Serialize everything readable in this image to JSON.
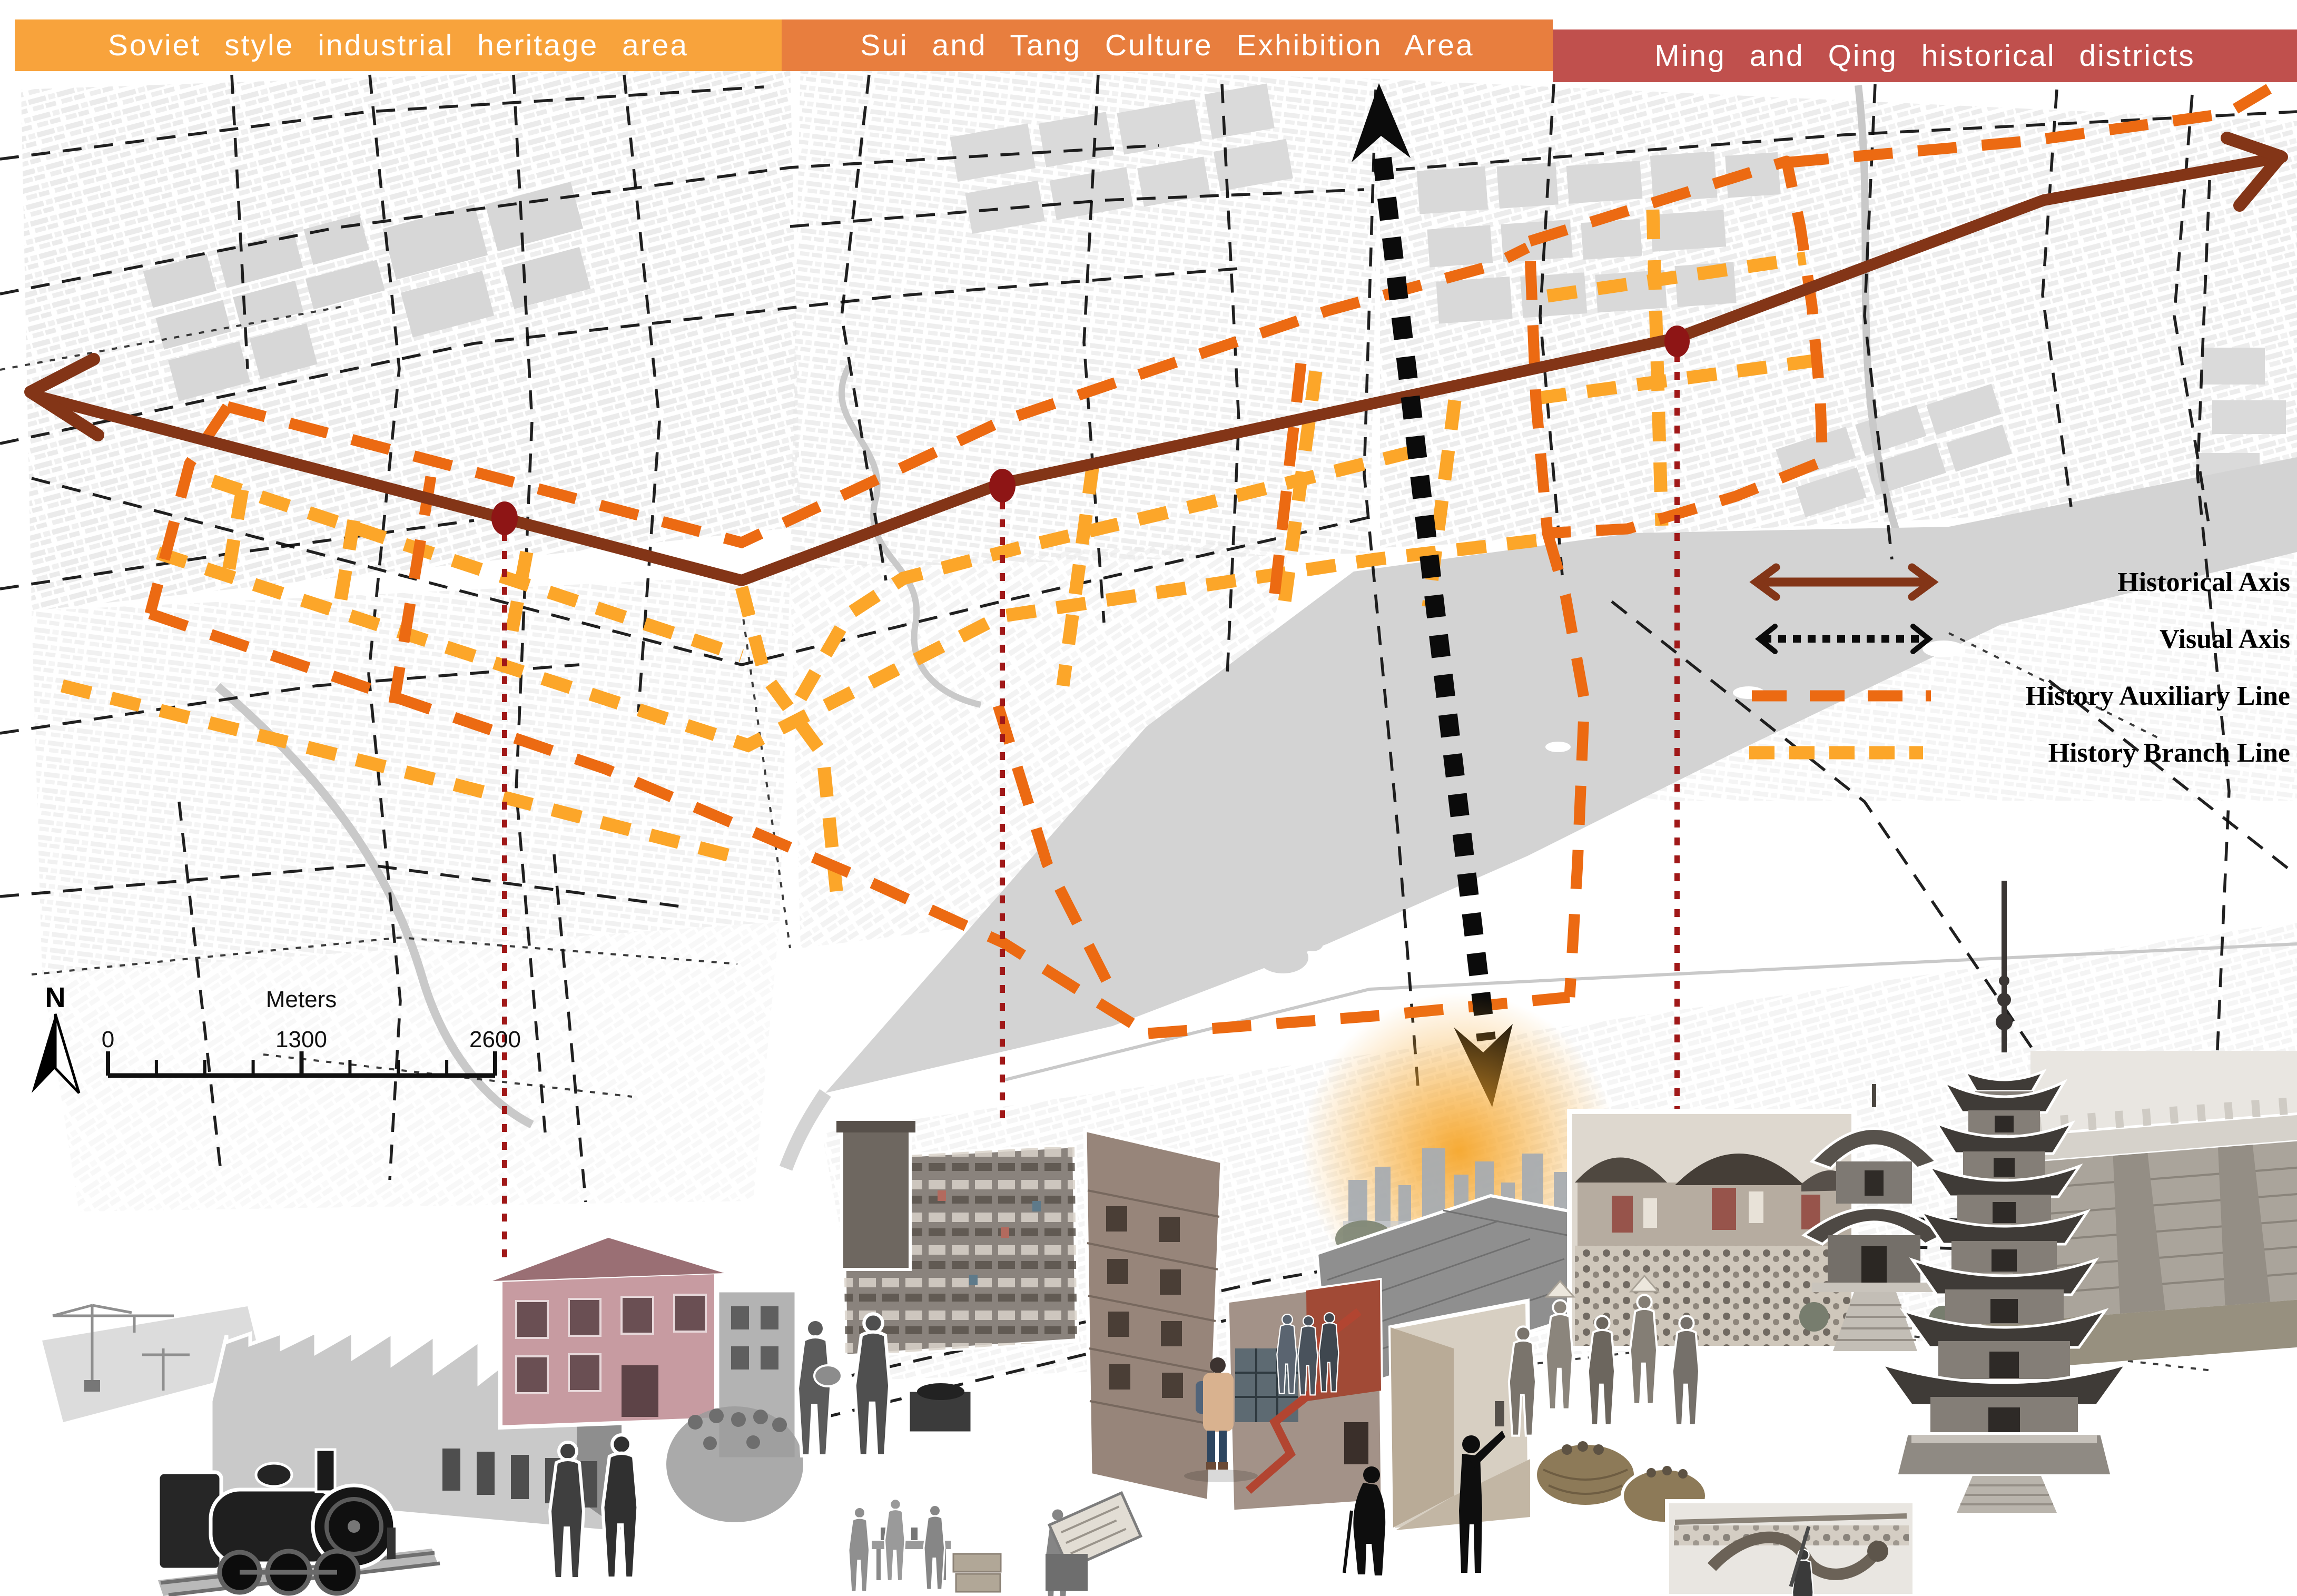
{
  "headers": [
    {
      "id": "soviet",
      "label": "Soviet style industrial heritage area"
    },
    {
      "id": "sui-tang",
      "label": "Sui and Tang Culture Exhibition Area"
    },
    {
      "id": "ming-qing",
      "label": "Ming and Qing historical districts"
    }
  ],
  "legend": {
    "items": [
      {
        "label": "Historical Axis",
        "symbol": "double-arrow-solid"
      },
      {
        "label": "Visual Axis",
        "symbol": "double-arrow-dotted"
      },
      {
        "label": "History Auxiliary Line",
        "symbol": "dashed-line-orange"
      },
      {
        "label": "History Branch Line",
        "symbol": "dashed-line-amber"
      }
    ]
  },
  "scale_bar": {
    "unit_label": "Meters",
    "tick_labels": [
      "0",
      "1300",
      "2600"
    ]
  },
  "compass": {
    "north_label": "N"
  },
  "colors": {
    "zone_soviet": "#F8A33C",
    "zone_sui_tang": "#E87E3E",
    "zone_ming_qing": "#C0504D",
    "header_text": "#FFFFFF",
    "historical_axis": "#833517",
    "visual_axis": "#0B0B0B",
    "history_auxiliary": "#EC6A12",
    "history_branch": "#FCA629",
    "axis_node": "#8E1515",
    "photo_link": "#A01818",
    "river": "#D3D3D3",
    "legend_text": "#000000"
  },
  "photos": {
    "left": "soviet-industrial-collage",
    "middle": "sui-tang-life-collage",
    "right": "ming-qing-heritage-collage"
  }
}
